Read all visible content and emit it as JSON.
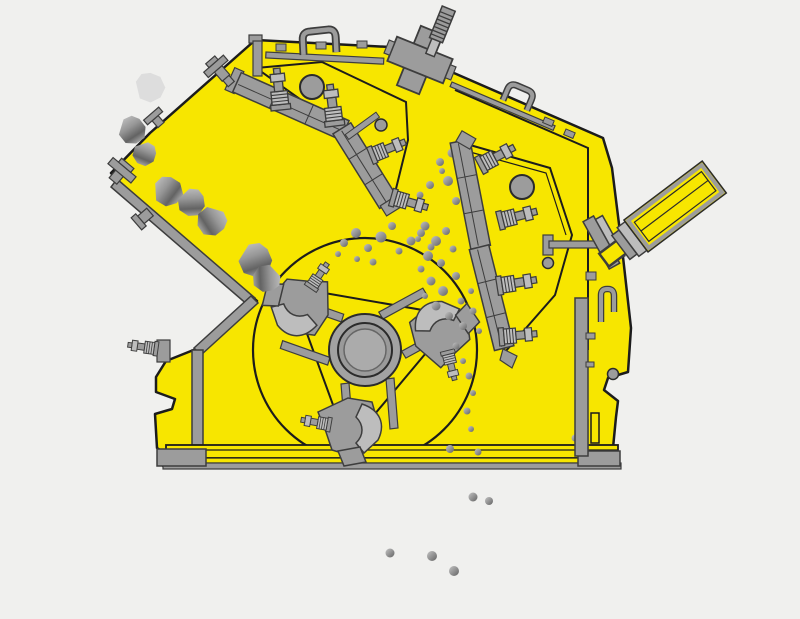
{
  "canvas": {
    "width": 800,
    "height": 619
  },
  "palette": {
    "background": "#f0f0ee",
    "body_yellow": "#f7e600",
    "outline": "#1c1c1c",
    "steel_mid": "#9c9c9c",
    "steel_light": "#bdbdbd",
    "steel_dark": "#6f6f6f",
    "steel_stroke": "#3d3d3d",
    "rock_a": "#c4c4c4",
    "rock_b": "#969696",
    "rock_c": "#636363",
    "rock_ghost": "#d8d8d8"
  },
  "parts": [
    "machine-housing",
    "feed-chute-liner",
    "lower-wall-liner",
    "rotor",
    "rotor-hub",
    "blow-bar-hammer",
    "upper-impact-apron",
    "lower-impact-apron",
    "apron-tension-bolt",
    "tension-rod",
    "rod-anchor-block",
    "hydraulic-adjuster-cylinder",
    "tie-rod",
    "lifting-handle",
    "deck-rail",
    "base-frame",
    "support-foot",
    "side-wall-liner",
    "inspection-hole",
    "feed-rock",
    "crushed-particle"
  ],
  "rocks": [
    {
      "x": 150,
      "y": 88,
      "s": 15,
      "rot": 10,
      "ghost": true,
      "o": 0.8
    },
    {
      "x": 132,
      "y": 131,
      "s": 14,
      "rot": 40
    },
    {
      "x": 144,
      "y": 154,
      "s": 12,
      "rot": 95
    },
    {
      "x": 168,
      "y": 192,
      "s": 15,
      "rot": 20
    },
    {
      "x": 191,
      "y": 203,
      "s": 14,
      "rot": 70
    },
    {
      "x": 211,
      "y": 221,
      "s": 15,
      "rot": 130
    },
    {
      "x": 255,
      "y": 261,
      "s": 17,
      "rot": 55
    },
    {
      "x": 266,
      "y": 278,
      "s": 14,
      "rot": 160
    }
  ],
  "particles": [
    [
      344,
      243,
      4
    ],
    [
      356,
      233,
      5
    ],
    [
      368,
      248,
      4
    ],
    [
      381,
      237,
      5.5
    ],
    [
      392,
      226,
      4
    ],
    [
      399,
      251,
      3.5
    ],
    [
      411,
      241,
      4.5
    ],
    [
      357,
      259,
      3
    ],
    [
      373,
      262,
      3.5
    ],
    [
      421,
      233,
      4
    ],
    [
      431,
      247,
      3.5
    ],
    [
      338,
      254,
      3
    ],
    [
      440,
      162,
      4
    ],
    [
      452,
      153,
      4.5
    ],
    [
      461,
      171,
      4
    ],
    [
      471,
      159,
      3.5
    ],
    [
      448,
      181,
      5
    ],
    [
      463,
      186,
      4
    ],
    [
      476,
      176,
      3.5
    ],
    [
      484,
      191,
      4.5
    ],
    [
      456,
      201,
      4
    ],
    [
      469,
      206,
      3.5
    ],
    [
      481,
      212,
      4
    ],
    [
      491,
      201,
      3
    ],
    [
      442,
      171,
      3
    ],
    [
      420,
      195,
      3.5
    ],
    [
      430,
      185,
      4
    ],
    [
      425,
      226,
      4.5
    ],
    [
      436,
      241,
      5
    ],
    [
      446,
      231,
      4
    ],
    [
      428,
      256,
      5
    ],
    [
      441,
      263,
      4
    ],
    [
      453,
      249,
      3.5
    ],
    [
      431,
      281,
      4.5
    ],
    [
      443,
      291,
      5
    ],
    [
      456,
      276,
      4
    ],
    [
      436,
      306,
      4.5
    ],
    [
      449,
      316,
      4
    ],
    [
      461,
      301,
      3.5
    ],
    [
      471,
      291,
      3
    ],
    [
      463,
      326,
      4
    ],
    [
      473,
      311,
      3.5
    ],
    [
      479,
      331,
      3
    ],
    [
      418,
      239,
      3
    ],
    [
      421,
      269,
      3.5
    ],
    [
      425,
      296,
      3
    ],
    [
      456,
      346,
      3.5
    ],
    [
      463,
      361,
      3
    ],
    [
      469,
      376,
      3.5
    ],
    [
      473,
      393,
      3
    ],
    [
      467,
      411,
      3.5
    ],
    [
      471,
      429,
      3
    ],
    [
      575,
      438,
      3.5
    ],
    [
      450,
      449,
      4
    ],
    [
      478,
      452,
      3.5
    ],
    [
      473,
      497,
      4.5
    ],
    [
      489,
      501,
      4
    ],
    [
      390,
      553,
      4.5
    ],
    [
      432,
      556,
      5
    ],
    [
      454,
      571,
      5
    ]
  ]
}
